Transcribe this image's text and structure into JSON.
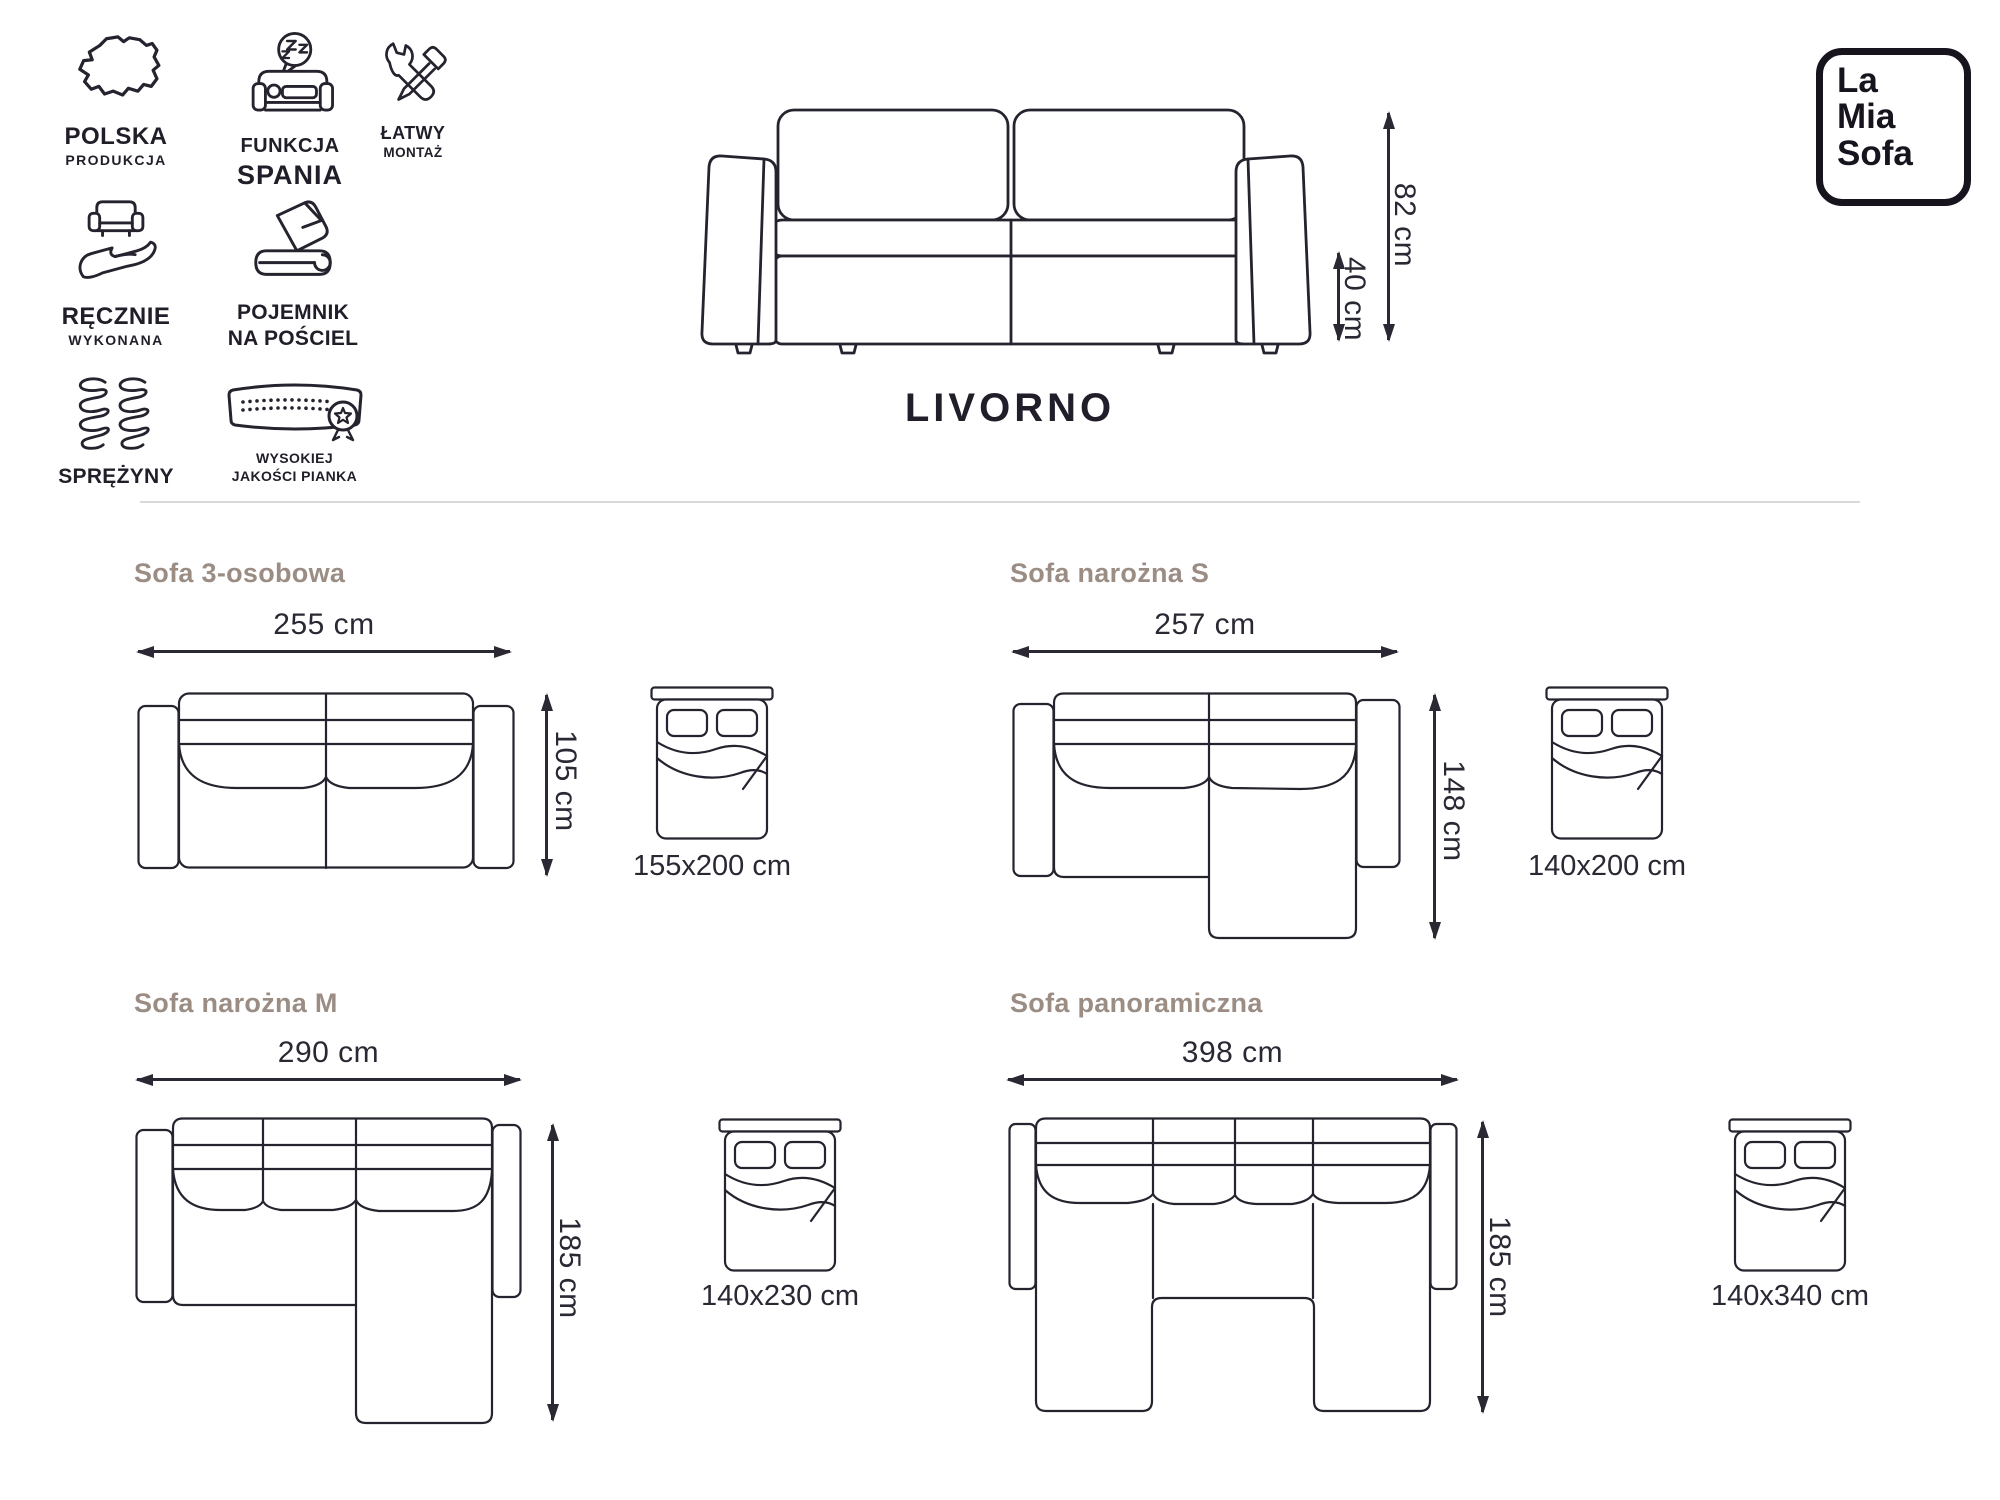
{
  "brand": {
    "line1": "La",
    "line2": "Mia",
    "line3": "Sofa"
  },
  "product": {
    "name": "LIVORNO"
  },
  "features": [
    {
      "icon": "poland-map-icon",
      "line1": "POLSKA",
      "line2": "PRODUKCJA"
    },
    {
      "icon": "sleep-function-icon",
      "line1": "FUNKCJA",
      "line2": "SPANIA"
    },
    {
      "icon": "easy-assembly-icon",
      "line1": "ŁATWY",
      "line2": "MONTAŻ"
    },
    {
      "icon": "handmade-icon",
      "line1": "RĘCZNIE",
      "line2": "WYKONANA"
    },
    {
      "icon": "bedding-storage-icon",
      "line1": "POJEMNIK",
      "line2": "NA POŚCIEL"
    },
    {
      "icon": "springs-icon",
      "line1": "SPRĘŻYNY",
      "line2": ""
    },
    {
      "icon": "foam-quality-icon",
      "line1": "WYSOKIEJ",
      "line2": "JAKOŚCI PIANKA"
    }
  ],
  "front_view": {
    "total_height": "82 cm",
    "seat_height": "40 cm"
  },
  "variants": [
    {
      "name": "Sofa 3-osobowa",
      "width": "255 cm",
      "depth": "105 cm",
      "bed_size": "155x200 cm"
    },
    {
      "name": "Sofa narożna S",
      "width": "257 cm",
      "depth": "148 cm",
      "bed_size": "140x200 cm"
    },
    {
      "name": "Sofa narożna M",
      "width": "290 cm",
      "depth": "185 cm",
      "bed_size": "140x230 cm"
    },
    {
      "name": "Sofa panoramiczna",
      "width": "398 cm",
      "depth": "185 cm",
      "bed_size": "140x340 cm"
    }
  ],
  "colors": {
    "ink": "#26222e",
    "heading": "#9b8d84",
    "divider": "#d9d9d9",
    "background": "#ffffff"
  }
}
